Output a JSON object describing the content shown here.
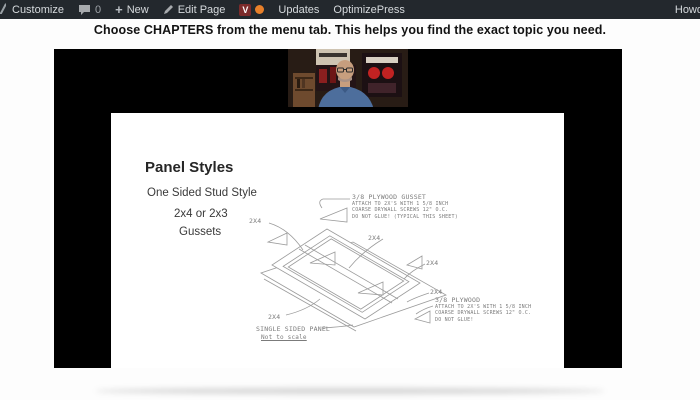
{
  "admin_bar": {
    "customize_label": "Customize",
    "comments_count": "0",
    "new_plus": "+",
    "new_label": "New",
    "edit_page_label": "Edit Page",
    "plugin_glyph": "V",
    "updates_label": "Updates",
    "optimizepress_label": "OptimizePress",
    "howdy_label": "Howd"
  },
  "header": {
    "headline": "Choose CHAPTERS from the menu tab. This helps you find the exact topic you need."
  },
  "video": {
    "slide": {
      "title": "Panel Styles",
      "line1": "One Sided Stud Style",
      "line2": "2x4 or 2x3",
      "line3": "Gussets",
      "gusset_note": [
        "3/8 PLYWOOD GUSSET",
        "ATTACH TO 2X'S WITH 1 5/8 INCH",
        "COARSE DRYWALL SCREWS 12\" O.C.",
        "DO NOT GLUE! (TYPICAL THIS SHEET)"
      ],
      "plywood_note": [
        "3/8 PLYWOOD",
        "ATTACH TO 2X'S WITH 1 5/8 INCH",
        "COARSE DRYWALL SCREWS 12\" O.C.",
        "DO NOT GLUE!"
      ],
      "labels_2x4": [
        "2X4",
        "2X4",
        "2X4",
        "2X4",
        "2X4"
      ],
      "panel_caption": "SINGLE SIDED PANEL",
      "panel_scale": "Not to scale"
    }
  },
  "colors": {
    "admin_bar_bg": "#23282d",
    "admin_bar_text": "#d6dadd",
    "notification_orange": "#e8802a",
    "plugin_maroon": "#7c2b2b",
    "player_bg": "#000000",
    "slide_bg": "#ffffff",
    "drafting_gray": "#9b9b9b"
  }
}
